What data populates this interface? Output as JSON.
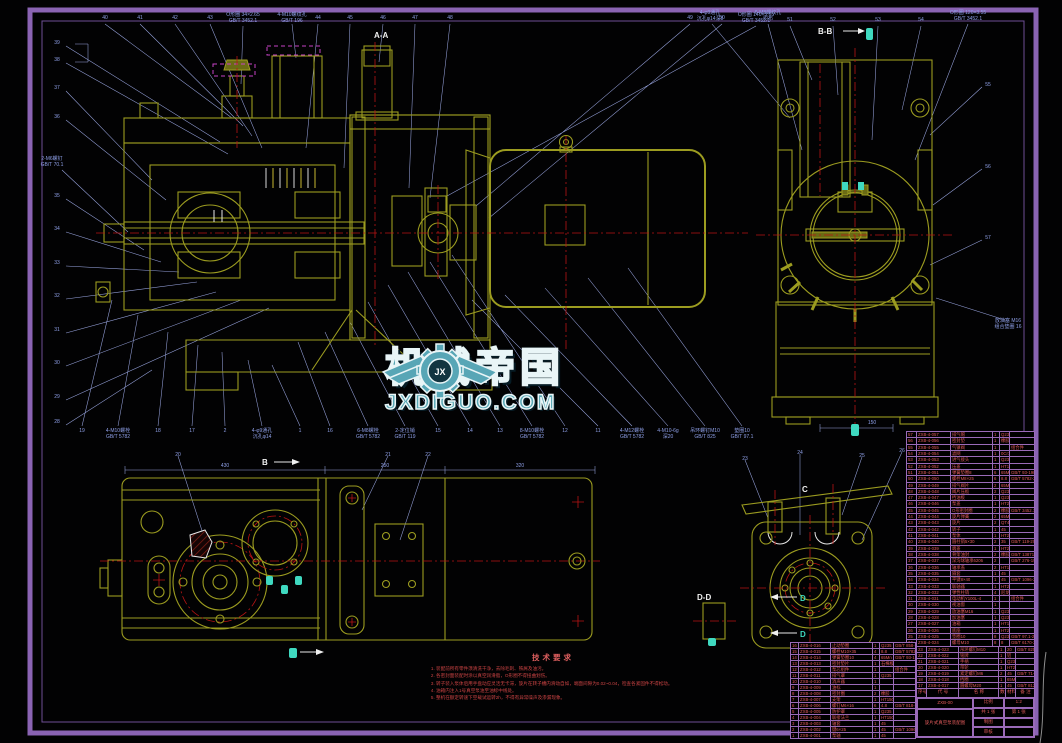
{
  "watermark": {
    "cn": "机械帝国",
    "en": "JXDIGUO.COM",
    "jx": "JX"
  },
  "labels": {
    "aa": "A-A",
    "bb": "B-B",
    "dd": "D-D",
    "b": "B",
    "c": "C",
    "d": "D"
  },
  "tech": {
    "title": "技术要求",
    "items": [
      "装配前所有零件须清洗干净，去除毛刺、铁屑及油污。",
      "各密封面装配时涂以真空润滑脂，O形圈不得扭曲划伤。",
      "转子装入泵体后用手盘动应灵活无卡滞，旋片在转子槽内滑动自如，端面间隙为0.02~0.04，检查各紧固件不得松动。",
      "油箱内注入1号真空泵油至油标中线处。",
      "整机在额定转速下空载试运转2h，不得有异常噪声及渗漏现象。"
    ]
  },
  "bom": {
    "header": [
      "序号",
      "代 号",
      "名 称",
      "数量",
      "材料",
      "备 注"
    ],
    "right": [
      [
        "57",
        "ZXB-4-057",
        "排气帽",
        "1",
        "Q235",
        ""
      ],
      [
        "56",
        "ZXB-4-056",
        "密封垫",
        "1",
        "橡胶",
        ""
      ],
      [
        "55",
        "ZXB-4-055",
        "气镇阀",
        "1",
        "",
        "组合件"
      ],
      [
        "54",
        "ZXB-4-054",
        "滤网",
        "1",
        "0Cr18",
        ""
      ],
      [
        "53",
        "ZXB-4-053",
        "进气接头",
        "1",
        "Q235",
        ""
      ],
      [
        "52",
        "ZXB-4-052",
        "压盖",
        "1",
        "HT150",
        ""
      ],
      [
        "51",
        "ZXB-4-051",
        "弹簧垫圈8",
        "6",
        "65Mn",
        "GB/T 93-1987"
      ],
      [
        "50",
        "ZXB-4-050",
        "螺栓M8×25",
        "6",
        "8.8",
        "GB/T 5782-2000"
      ],
      [
        "49",
        "ZXB-4-049",
        "排气阀片",
        "2",
        "65Mn",
        ""
      ],
      [
        "48",
        "ZXB-4-048",
        "阀片压板",
        "2",
        "Q235",
        ""
      ],
      [
        "47",
        "ZXB-4-047",
        "挡油板",
        "1",
        "Q235",
        ""
      ],
      [
        "46",
        "ZXB-4-046",
        "泵盖",
        "1",
        "HT200",
        ""
      ],
      [
        "45",
        "ZXB-4-045",
        "O形密封圈",
        "2",
        "橡胶",
        "GB/T 3452.1-2005"
      ],
      [
        "44",
        "ZXB-4-044",
        "旋片弹簧",
        "2",
        "65Mn",
        ""
      ],
      [
        "43",
        "ZXB-4-043",
        "旋片",
        "2",
        "QT400",
        ""
      ],
      [
        "42",
        "ZXB-4-042",
        "转子",
        "1",
        "45",
        ""
      ],
      [
        "41",
        "ZXB-4-041",
        "泵体",
        "1",
        "HT200",
        ""
      ],
      [
        "40",
        "ZXB-4-040",
        "圆柱销5×30",
        "2",
        "35",
        "GB/T 119-2000"
      ],
      [
        "39",
        "ZXB-4-039",
        "端盖",
        "1",
        "HT200",
        ""
      ],
      [
        "38",
        "ZXB-4-038",
        "骨架油封",
        "2",
        "橡胶",
        "GB/T 13871-1992"
      ],
      [
        "37",
        "ZXB-4-037",
        "深沟球轴承6206",
        "2",
        "",
        "GB/T 276-1994"
      ],
      [
        "36",
        "ZXB-4-036",
        "轴承盖",
        "2",
        "HT150",
        ""
      ],
      [
        "35",
        "ZXB-4-035",
        "隔套",
        "1",
        "45",
        ""
      ],
      [
        "34",
        "ZXB-4-034",
        "平键8×40",
        "1",
        "45",
        "GB/T 1096-2003"
      ],
      [
        "33",
        "ZXB-4-033",
        "联轴器",
        "1",
        "HT200",
        ""
      ],
      [
        "32",
        "ZXB-4-032",
        "弹性柱销",
        "4",
        "尼龙",
        ""
      ],
      [
        "31",
        "ZXB-4-031",
        "电动机Y100L-4",
        "1",
        "",
        "组合件"
      ],
      [
        "30",
        "ZXB-4-030",
        "视油窗",
        "1",
        "",
        ""
      ],
      [
        "29",
        "ZXB-4-029",
        "放油塞M16",
        "1",
        "Q235",
        ""
      ],
      [
        "28",
        "ZXB-4-028",
        "加油塞",
        "1",
        "Q235",
        ""
      ],
      [
        "27",
        "ZXB-4-027",
        "油箱",
        "1",
        "HT150",
        ""
      ],
      [
        "26",
        "ZXB-4-026",
        "底座",
        "1",
        "HT200",
        ""
      ],
      [
        "25",
        "ZXB-4-025",
        "垫圈10",
        "8",
        "Q235",
        "GB/T 97.1-2002"
      ],
      [
        "24",
        "ZXB-4-024",
        "螺母M10",
        "8",
        "8",
        "GB/T 6170-2000"
      ]
    ],
    "right2": [
      [
        "23",
        "ZXB-4-023",
        "吊环螺钉M10",
        "1",
        "20",
        "GB/T 825-1988"
      ],
      [
        "22",
        "ZXB-4-022",
        "铭牌",
        "1",
        "铝",
        ""
      ],
      [
        "21",
        "ZXB-4-021",
        "手柄",
        "1",
        "Q235",
        ""
      ],
      [
        "20",
        "ZXB-4-020",
        "带轮",
        "1",
        "HT200",
        ""
      ],
      [
        "19",
        "ZXB-4-019",
        "紧定螺钉M6",
        "2",
        "45",
        "GB/T 71-1985"
      ],
      [
        "18",
        "ZXB-4-018",
        "挡圈",
        "1",
        "65Mn",
        ""
      ],
      [
        "17",
        "ZXB-4-017",
        "圆螺母M20",
        "1",
        "45",
        "GB/T 812-1988"
      ]
    ],
    "left": [
      [
        "16",
        "ZXB-4-016",
        "止动垫圈",
        "1",
        "Q235",
        "GB/T 858-1988"
      ],
      [
        "15",
        "ZXB-4-015",
        "螺栓M10×35",
        "4",
        "8.8",
        "GB/T 5782-2000"
      ],
      [
        "14",
        "ZXB-4-014",
        "弹簧垫圈10",
        "4",
        "65Mn",
        "GB/T 93-1987"
      ],
      [
        "13",
        "ZXB-4-013",
        "密封垫片",
        "1",
        "石棉板",
        ""
      ],
      [
        "12",
        "ZXB-4-012",
        "泵芯组件",
        "1",
        "",
        "组合件"
      ],
      [
        "11",
        "ZXB-4-011",
        "排气罩",
        "1",
        "Q235",
        ""
      ],
      [
        "10",
        "ZXB-4-010",
        "消声器",
        "1",
        "",
        ""
      ],
      [
        "9",
        "ZXB-4-009",
        "油标",
        "1",
        "",
        ""
      ],
      [
        "8",
        "ZXB-4-008",
        "密封圈",
        "2",
        "橡胶",
        ""
      ],
      [
        "7",
        "ZXB-4-007",
        "支架",
        "1",
        "HT150",
        ""
      ],
      [
        "6",
        "ZXB-4-006",
        "螺钉M6×16",
        "6",
        "4.8",
        "GB/T 818-2000"
      ],
      [
        "5",
        "ZXB-4-005",
        "防护罩",
        "1",
        "Q235",
        ""
      ],
      [
        "4",
        "ZXB-4-004",
        "联接法兰",
        "1",
        "HT150",
        ""
      ],
      [
        "3",
        "ZXB-4-003",
        "轴套",
        "1",
        "45",
        ""
      ],
      [
        "2",
        "ZXB-4-002",
        "键6×25",
        "1",
        "45",
        "GB/T 1096-2003"
      ],
      [
        "1",
        "ZXB-4-001",
        "泵轴",
        "1",
        "45",
        ""
      ]
    ]
  },
  "title_block": {
    "doc_code": "ZXB-00",
    "title": "旋片式真空泵装配图",
    "scale_label": "比例",
    "scale_value": "1:2",
    "sheet_label": "共 1 张",
    "sheet2_label": "第 1 张",
    "drawn_label": "制图",
    "drawn_value": "",
    "checked_label": "审核",
    "checked_value": ""
  },
  "callouts": {
    "top": [
      {
        "x": 105,
        "y": 15,
        "t": "40"
      },
      {
        "x": 140,
        "y": 15,
        "t": "41"
      },
      {
        "x": 175,
        "y": 15,
        "t": "42"
      },
      {
        "x": 210,
        "y": 15,
        "t": "43"
      },
      {
        "x": 243,
        "y": 12,
        "t": "O形圈 34×2.65\nGB/T 3452.1"
      },
      {
        "x": 292,
        "y": 12,
        "t": "4-M10螺纹孔\nGB/T 196"
      },
      {
        "x": 318,
        "y": 15,
        "t": "44"
      },
      {
        "x": 350,
        "y": 15,
        "t": "45"
      },
      {
        "x": 383,
        "y": 15,
        "t": "46"
      },
      {
        "x": 415,
        "y": 15,
        "t": "47"
      },
      {
        "x": 450,
        "y": 15,
        "t": "48"
      },
      {
        "x": 690,
        "y": 15,
        "t": "49"
      },
      {
        "x": 722,
        "y": 15,
        "t": "50"
      },
      {
        "x": 756,
        "y": 12,
        "t": "O形圈 140×3.55\nGB/T 3452.1"
      }
    ],
    "left": [
      {
        "x": 57,
        "y": 40,
        "t": "39"
      },
      {
        "x": 57,
        "y": 57,
        "t": "38"
      },
      {
        "x": 57,
        "y": 85,
        "t": "37"
      },
      {
        "x": 57,
        "y": 114,
        "t": "36"
      },
      {
        "x": 52,
        "y": 156,
        "t": "2-M6螺钉\nGB/T 70.1"
      },
      {
        "x": 57,
        "y": 193,
        "t": "35"
      },
      {
        "x": 57,
        "y": 226,
        "t": "34"
      },
      {
        "x": 57,
        "y": 260,
        "t": "33"
      },
      {
        "x": 57,
        "y": 293,
        "t": "32"
      },
      {
        "x": 57,
        "y": 327,
        "t": "31"
      },
      {
        "x": 57,
        "y": 360,
        "t": "30"
      },
      {
        "x": 57,
        "y": 394,
        "t": "29"
      },
      {
        "x": 57,
        "y": 419,
        "t": "28"
      }
    ],
    "bottom": [
      {
        "x": 82,
        "y": 428,
        "t": "19"
      },
      {
        "x": 118,
        "y": 428,
        "t": "4-M10螺栓\nGB/T 5782"
      },
      {
        "x": 158,
        "y": 428,
        "t": "18"
      },
      {
        "x": 192,
        "y": 428,
        "t": "17"
      },
      {
        "x": 225,
        "y": 428,
        "t": "2"
      },
      {
        "x": 262,
        "y": 428,
        "t": "4-φ9通孔\n沉孔φ14"
      },
      {
        "x": 300,
        "y": 428,
        "t": "1"
      },
      {
        "x": 330,
        "y": 428,
        "t": "16"
      },
      {
        "x": 368,
        "y": 428,
        "t": "6-M8螺栓\nGB/T 5782"
      },
      {
        "x": 405,
        "y": 428,
        "t": "2-定位销\nGB/T 119"
      },
      {
        "x": 438,
        "y": 428,
        "t": "15"
      },
      {
        "x": 470,
        "y": 428,
        "t": "14"
      },
      {
        "x": 500,
        "y": 428,
        "t": "13"
      },
      {
        "x": 532,
        "y": 428,
        "t": "8-M10螺栓\nGB/T 5782"
      },
      {
        "x": 565,
        "y": 428,
        "t": "12"
      },
      {
        "x": 598,
        "y": 428,
        "t": "11"
      },
      {
        "x": 632,
        "y": 428,
        "t": "4-M12螺栓\nGB/T 5782"
      },
      {
        "x": 668,
        "y": 428,
        "t": "4-M10-6g\n深20"
      },
      {
        "x": 705,
        "y": 428,
        "t": "吊环螺钉M10\nGB/T 825"
      },
      {
        "x": 742,
        "y": 428,
        "t": "垫圈10\nGB/T 97.1"
      }
    ],
    "bbtop": [
      {
        "x": 710,
        "y": 10,
        "t": "4-φ9通孔\n沉孔φ14深8"
      },
      {
        "x": 768,
        "y": 10,
        "t": "6-M8螺纹孔\n均布"
      },
      {
        "x": 790,
        "y": 17,
        "t": "51"
      },
      {
        "x": 833,
        "y": 17,
        "t": "52"
      },
      {
        "x": 878,
        "y": 17,
        "t": "53"
      },
      {
        "x": 921,
        "y": 17,
        "t": "54"
      },
      {
        "x": 968,
        "y": 10,
        "t": "O形圈 120×3.55\nGB/T 3452.1"
      }
    ],
    "bbright": [
      {
        "x": 988,
        "y": 82,
        "t": "55"
      },
      {
        "x": 988,
        "y": 164,
        "t": "56"
      },
      {
        "x": 988,
        "y": 235,
        "t": "57"
      },
      {
        "x": 1008,
        "y": 318,
        "t": "放油塞 M16\n组合垫圈 16"
      }
    ],
    "plan": [
      {
        "x": 178,
        "y": 452,
        "t": "20"
      },
      {
        "x": 388,
        "y": 452,
        "t": "21"
      },
      {
        "x": 428,
        "y": 452,
        "t": "22"
      },
      {
        "x": 745,
        "y": 456,
        "t": "23"
      },
      {
        "x": 800,
        "y": 450,
        "t": "24"
      },
      {
        "x": 862,
        "y": 453,
        "t": "25"
      },
      {
        "x": 902,
        "y": 448,
        "t": "26"
      }
    ],
    "dims": [
      {
        "x": 225,
        "y": 463,
        "t": "430"
      },
      {
        "x": 385,
        "y": 463,
        "t": "250"
      },
      {
        "x": 520,
        "y": 463,
        "t": "320"
      },
      {
        "x": 872,
        "y": 420,
        "t": "150"
      }
    ]
  }
}
